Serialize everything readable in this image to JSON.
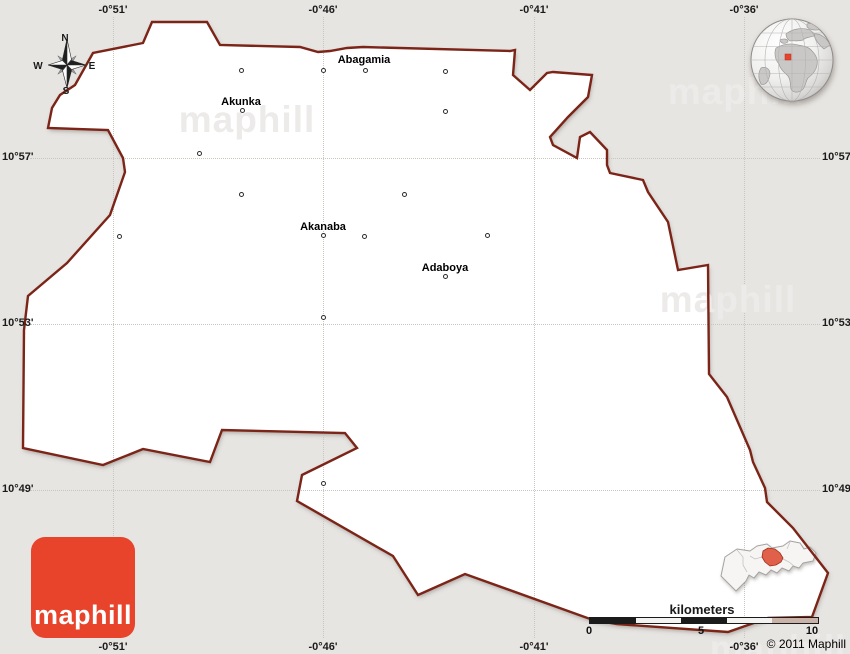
{
  "compass": {
    "north": "N",
    "east": "E",
    "south": "S",
    "west": "W"
  },
  "grid": {
    "meridians": [
      {
        "label": "-0°51'"
      },
      {
        "label": "-0°46'"
      },
      {
        "label": "-0°41'"
      },
      {
        "label": "-0°36'"
      }
    ],
    "parallels": [
      {
        "label": "10°57'"
      },
      {
        "label": "10°53'"
      },
      {
        "label": "10°49'"
      }
    ]
  },
  "places": [
    {
      "name": "Abagamia"
    },
    {
      "name": "Akunka"
    },
    {
      "name": "Akanaba"
    },
    {
      "name": "Adaboya"
    }
  ],
  "scalebar": {
    "unit": "kilometers",
    "ticks": [
      "0",
      "5",
      "10"
    ]
  },
  "branding": {
    "logo_text": "maphill",
    "watermark_text": "maphill",
    "copyright": "© 2011 Maphill"
  },
  "colors": {
    "background": "#e7e5e2",
    "region_fill": "#ffffff",
    "region_border": "#7b2417",
    "logo_red": "#e8432b",
    "inset_highlight": "#e0614a",
    "globe_marker": "#e8432b",
    "scalebar_dark": "#1b1b1b"
  }
}
